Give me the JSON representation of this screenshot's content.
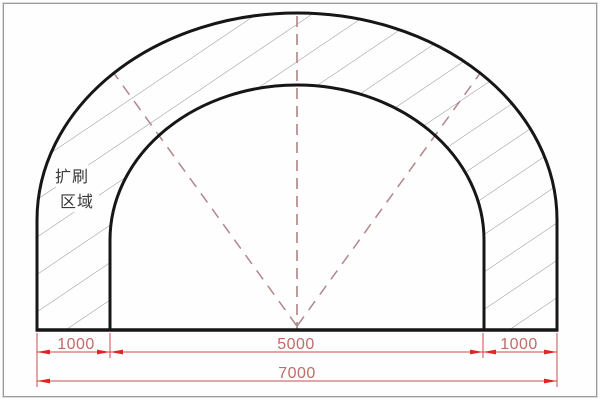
{
  "drawing": {
    "title": "tunnel-expansion-cross-section",
    "region_label": {
      "line1": "扩刷",
      "line2": "区域"
    },
    "dimensions": {
      "left_offset": "1000",
      "inner_span": "5000",
      "right_offset": "1000",
      "total_span": "7000"
    },
    "colors": {
      "outline": "#161616",
      "hatch": "#929292",
      "centerline": "#b08a8c",
      "sightline": "#b2868a",
      "dimension_line": "#cf4a4a",
      "dimension_arrow": "#e02525",
      "dimension_text": "#c16a6a",
      "region_text": "#383838"
    }
  }
}
